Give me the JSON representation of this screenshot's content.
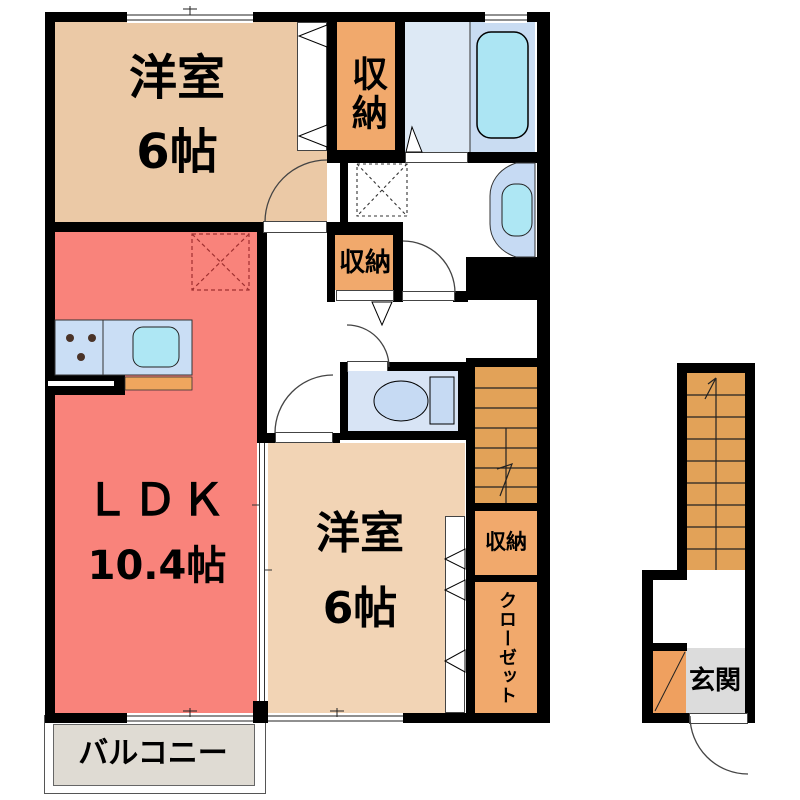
{
  "plan_title": "2F apartment floor plan",
  "rooms": {
    "west_room_top": {
      "name": "洋室",
      "size": "6帖"
    },
    "ldk": {
      "name": "ＬＤＫ",
      "size": "10.4帖"
    },
    "west_room_bottom": {
      "name": "洋室",
      "size": "6帖"
    },
    "storage_top": {
      "label": "収納"
    },
    "storage_hall": {
      "label": "収納"
    },
    "storage_right": {
      "label": "収納"
    },
    "closet": {
      "label": "クローゼット"
    },
    "balcony": {
      "label": "バルコニー"
    },
    "entrance": {
      "label": "玄関"
    }
  },
  "fixtures": [
    "bathtub-icon",
    "washbasin-icon",
    "toilet-icon",
    "kitchen-counter-icon",
    "stove-burners-icon",
    "kitchen-sink-icon",
    "washer-pan-icon",
    "stairs-up-icon",
    "door-swing-arc",
    "window-symbol",
    "sliding-door-symbol",
    "shoe-cabinet-icon"
  ],
  "palette": {
    "wall": "#000000",
    "room_tan_top": "#ebc9a6",
    "room_tan_bottom": "#f2d4b5",
    "ldk_red": "#f9837b",
    "storage_orange": "#f1a96c",
    "stairs_orange": "#e2a258",
    "genkan_gray": "#dcdcdc",
    "shoebox_orange": "#efa05f",
    "balcony_beige": "#dfdbd3",
    "bath_floor": "#dde9f5",
    "tub_zone": "#c9dcf2",
    "tub_fill": "#ace5f3",
    "fixture_blue": "#c6daf3",
    "sink_cyan": "#aee7f4",
    "toilet_floor": "#d8e4f5",
    "kitchen_counter": "#cadef5",
    "line": "#333333"
  }
}
